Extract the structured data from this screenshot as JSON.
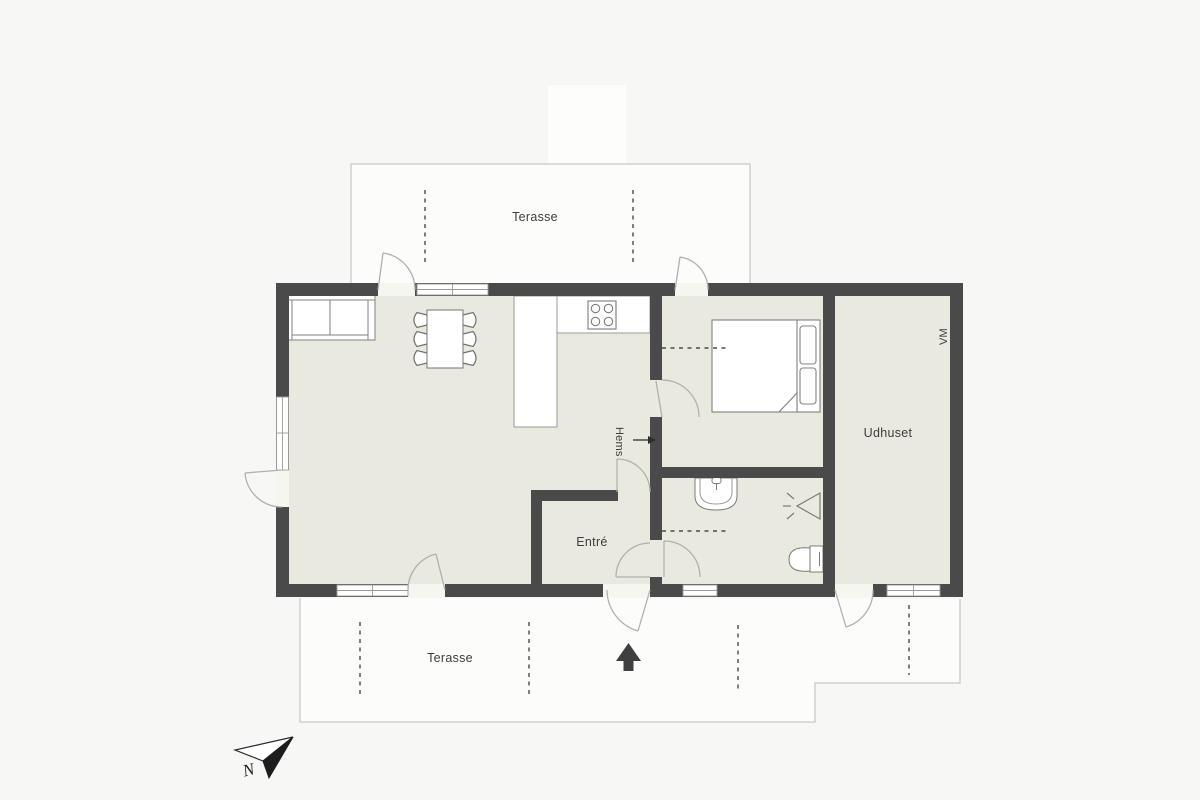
{
  "title": "Summerhouse floor plan",
  "labels": {
    "terrace_top": "Terasse",
    "terrace_bottom": "Terasse",
    "entry": "Entré",
    "outhouse": "Udhuset",
    "loft": "Hems",
    "washing_machine": "VM",
    "north": "N"
  },
  "rooms": [
    {
      "name": "living-kitchen",
      "label": ""
    },
    {
      "name": "bedroom",
      "label": ""
    },
    {
      "name": "bathroom",
      "label": ""
    },
    {
      "name": "entry-hall",
      "label": "Entré"
    },
    {
      "name": "outhouse",
      "label": "Udhuset"
    },
    {
      "name": "terrace-north",
      "label": "Terasse"
    },
    {
      "name": "terrace-south",
      "label": "Terasse"
    }
  ],
  "annotations": [
    {
      "name": "loft-marker",
      "label": "Hems",
      "arrow": "points right toward interior wall"
    },
    {
      "name": "washing-machine-marker",
      "label": "VM"
    },
    {
      "name": "entrance-marker",
      "icon": "solid-up-arrow"
    },
    {
      "name": "compass",
      "label": "N",
      "icon": "north-arrow"
    }
  ],
  "furniture": [
    "sofa",
    "dining-table",
    "six-chairs",
    "kitchen-counter-L",
    "stove-4-burners",
    "double-bed-with-pillows",
    "bathroom-sink",
    "shower-symbol",
    "toilet"
  ],
  "colors": {
    "background": "#f7f7f5",
    "floor": "#e9e9e0",
    "wall": "#4a4a4a",
    "furniture_outline": "#82827e",
    "door_arc": "#b0b0ae",
    "terrace_outline": "#c9c9c7",
    "text": "#3d3d3d",
    "arrow_dark": "#3f3f3f"
  }
}
